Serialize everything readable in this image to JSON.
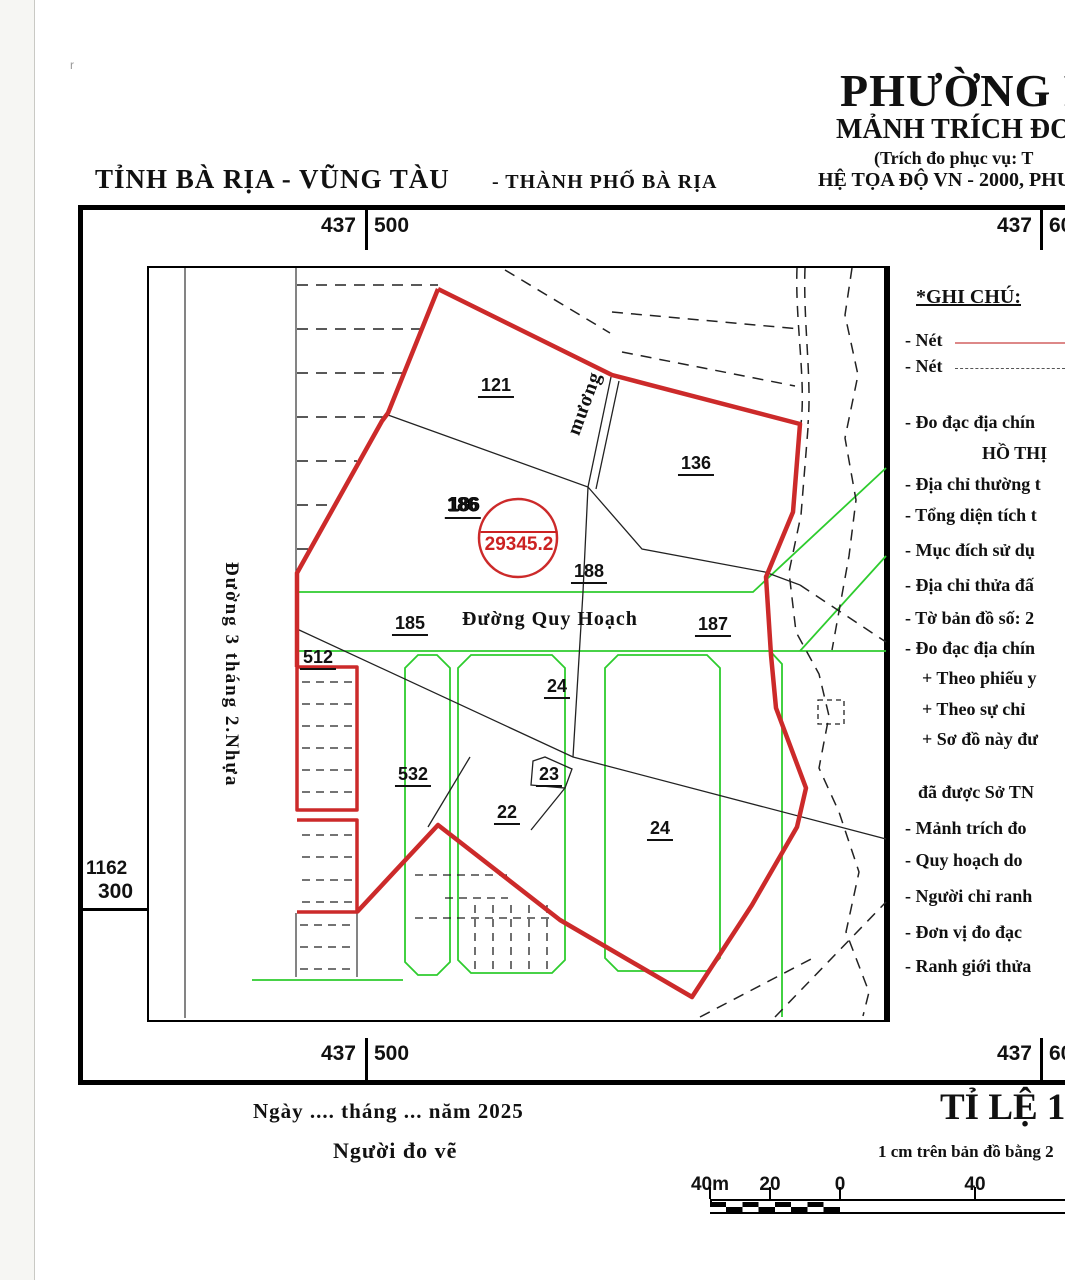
{
  "meta": {
    "corner_mark": "r"
  },
  "header": {
    "province_title": "TỈNH BÀ RỊA - VŨNG TÀU",
    "city_title": "- THÀNH PHỐ BÀ RỊA",
    "ward_title": "PHƯỜNG P",
    "doc_title": "MẢNH TRÍCH ĐO Đ",
    "doc_subtitle": "(Trích đo phục vụ: T",
    "coord_system": "HỆ TỌA ĐỘ VN - 2000, PHU"
  },
  "grid": {
    "top_left": [
      "437",
      "500"
    ],
    "top_right": [
      "437",
      "60"
    ],
    "bottom_left": [
      "437",
      "500"
    ],
    "bottom_right": [
      "437",
      "60"
    ],
    "left_mark": [
      "1162",
      "300"
    ]
  },
  "map": {
    "road_left_label": "Đường 3 tháng 2.Nhựa",
    "road_label": "Đường Quy Hoạch",
    "stream_label": "mương",
    "highlight": {
      "parcel": "186",
      "area": "29345.2"
    },
    "parcels": [
      {
        "label": "121"
      },
      {
        "label": "136"
      },
      {
        "label": "186"
      },
      {
        "label": "188"
      },
      {
        "label": "185"
      },
      {
        "label": "187"
      },
      {
        "label": "512"
      },
      {
        "label": "24"
      },
      {
        "label": "23"
      },
      {
        "label": "22"
      },
      {
        "label": "532"
      },
      {
        "label": "24"
      }
    ],
    "colors": {
      "boundary_red": "#cc2a2a",
      "planning_green": "#2ecc2e",
      "line_black": "#222222"
    }
  },
  "legend": {
    "title": "*GHI CHÚ:",
    "line_samples": [
      {
        "text": "- Nét",
        "style": "solid-red"
      },
      {
        "text": "- Nét",
        "style": "dashed-black"
      }
    ],
    "items": [
      "- Đo đạc địa chín",
      "HỒ THỊ",
      "- Địa chỉ thường t",
      "- Tổng diện tích t",
      "- Mục đích sử dụ",
      "- Địa chỉ thửa đấ",
      "- Tờ bản đồ số: 2",
      "- Đo đạc địa chín",
      "+ Theo phiếu y",
      "+ Theo sự chỉ",
      "+ Sơ đồ này đư",
      "đã được Sở TN",
      "- Mảnh trích đo",
      "- Quy hoạch do",
      "- Người chỉ ranh",
      "- Đơn vị đo đạc",
      "- Ranh giới thửa"
    ]
  },
  "footer": {
    "date_line": "Ngày  ....  tháng ...  năm 2025",
    "surveyor_line": "Người đo vẽ",
    "scale_title": "TỈ LỆ 1/",
    "scale_note": "1 cm trên bản đồ bằng 2",
    "scale_bar_labels": [
      "40m",
      "20",
      "0",
      "40"
    ]
  }
}
